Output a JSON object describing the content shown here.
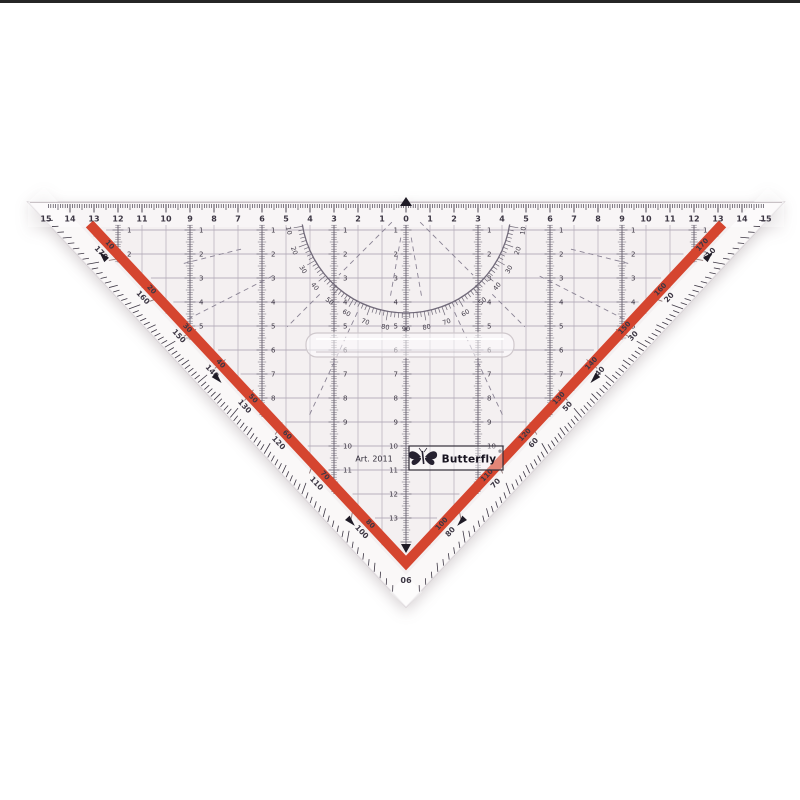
{
  "product": {
    "brand": "Butterfly",
    "trademark": "®",
    "article": "Art. 2011",
    "apex_degree": "90",
    "type_description": "transparent protractor set-square ruler"
  },
  "colors": {
    "background": "#ffffff",
    "body": "#f4f0f1",
    "body_edge": "#d8d2d6",
    "markings": "#3d3744",
    "band": "#6e6876",
    "grid": "#a39bab",
    "fine_grid": "#b3abb8",
    "arc": "#716a7a",
    "red_stripe": "#d5452f",
    "red_labels": "#7d2014",
    "arrow": "#1f1b26"
  },
  "scales": {
    "top_cm": {
      "left": [
        "15",
        "14",
        "13",
        "12",
        "11",
        "10",
        "9",
        "8",
        "7",
        "6",
        "5",
        "4",
        "3",
        "2",
        "1"
      ],
      "center": "0",
      "right": [
        "1",
        "2",
        "3",
        "4",
        "5",
        "6",
        "7",
        "8",
        "9",
        "10",
        "11",
        "12",
        "13",
        "14",
        "15"
      ]
    },
    "columns": [
      {
        "offset_cm": 0,
        "rows": [
          "1",
          "2",
          "3",
          "4",
          "5",
          "6",
          "7",
          "8",
          "9",
          "10",
          "11",
          "12",
          "13"
        ]
      },
      {
        "offset_cm": 3,
        "rows": [
          "1",
          "2",
          "3",
          "4",
          "5",
          "6",
          "7",
          "8",
          "9",
          "10",
          "11"
        ]
      },
      {
        "offset_cm": 6,
        "rows": [
          "1",
          "2",
          "3",
          "4",
          "5",
          "6",
          "7",
          "8"
        ]
      },
      {
        "offset_cm": 9,
        "rows": [
          "1",
          "2",
          "3",
          "4",
          "5"
        ]
      },
      {
        "offset_cm": 12,
        "rows": [
          "1",
          "2"
        ]
      }
    ],
    "hyp_left_outer": [
      "170",
      "160",
      "150",
      "140",
      "130",
      "120",
      "110",
      "100"
    ],
    "hyp_left_inner": [
      "10",
      "20",
      "30",
      "40",
      "50",
      "60",
      "70",
      "80"
    ],
    "hyp_right_outer": [
      "10",
      "20",
      "30",
      "40",
      "50",
      "60",
      "70",
      "80"
    ],
    "hyp_right_inner": [
      "170",
      "160",
      "150",
      "140",
      "130",
      "120",
      "110",
      "100"
    ],
    "protractor": [
      "10",
      "20",
      "30",
      "40",
      "50",
      "60",
      "70",
      "80",
      "90",
      "80",
      "70",
      "60",
      "50",
      "40",
      "30",
      "20",
      "10"
    ]
  }
}
